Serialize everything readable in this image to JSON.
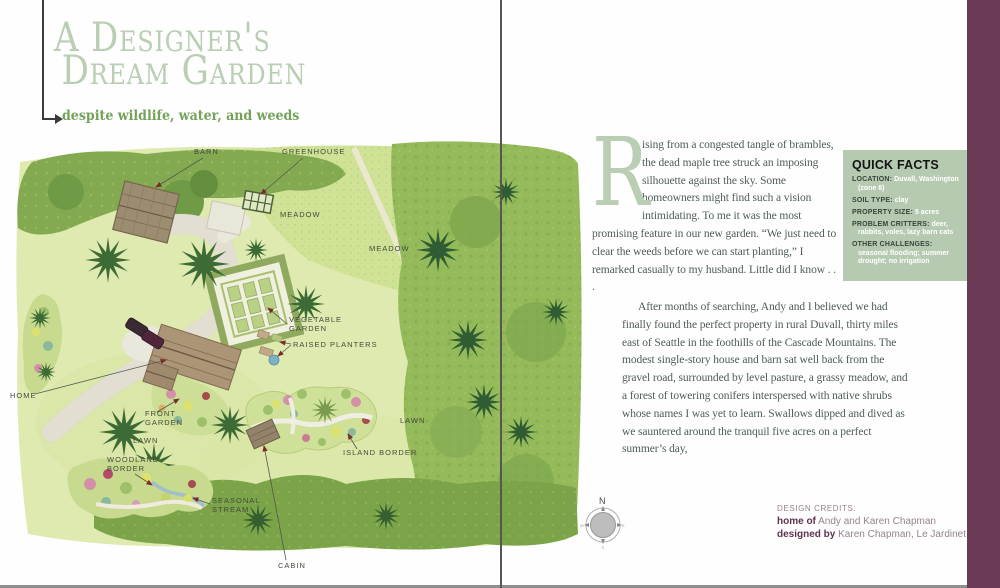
{
  "left_page": {
    "title_line1": "A Designer's",
    "title_line2": "Dream Garden",
    "subtitle": "despite wildlife, water, and weeds",
    "map_labels": {
      "barn": "BARN",
      "greenhouse": "GREENHOUSE",
      "meadow": "MEADOW",
      "vegetable_line1": "VEGETABLE",
      "vegetable_line2": "GARDEN",
      "raised_planters": "RAISED PLANTERS",
      "home": "HOME",
      "front_line1": "FRONT",
      "front_line2": "GARDEN",
      "lawn": "LAWN",
      "woodland_line1": "WOODLAND",
      "woodland_line2": "BORDER",
      "seasonal_line1": "SEASONAL",
      "seasonal_line2": "STREAM",
      "island_border": "ISLAND BORDER",
      "cabin": "CABIN"
    }
  },
  "right_page": {
    "dropcap": "R",
    "para1": "ising from a congested tangle of brambles, the dead maple tree struck an imposing silhouette against the sky. Some homeowners might find such a vision intimidating. To me it was the most promising feature in our new garden. “We just need to clear the weeds before we can start planting,” I remarked casually to my husband. Little did I know . . .",
    "para2": "After months of searching, Andy and I believed we had finally found the perfect property in rural Duvall, thirty miles east of Seattle in the foothills of the Cascade Mountains. The modest single-story house and barn sat well back from the gravel road, surrounded by level pasture, a grassy meadow, and a forest of towering conifers interspersed with native shrubs whose names I was yet to learn. Swallows dipped and dived as we sauntered around the tranquil five acres on a perfect summer’s day,",
    "quick_facts": {
      "title": "QUICK FACTS",
      "items": [
        {
          "label": "LOCATION:",
          "value": "Duvall, Washington (zone 6)"
        },
        {
          "label": "SOIL TYPE:",
          "value": "clay"
        },
        {
          "label": "PROPERTY SIZE:",
          "value": "5 acres"
        },
        {
          "label": "PROBLEM CRITTERS:",
          "value": "deer, rabbits, voles, lazy barn cats"
        },
        {
          "label": "OTHER CHALLENGES:",
          "value": "seasonal flooding; summer drought; no irrigation"
        }
      ]
    },
    "compass": {
      "north": "N",
      "east": "E",
      "south": "S",
      "west": "W"
    },
    "credits": {
      "heading": "DESIGN CREDITS:",
      "home_of_label": "home of",
      "home_of_value": "Andy and Karen Chapman",
      "designed_by_label": "designed by",
      "designed_by_value": "Karen Chapman, Le Jardinet"
    }
  },
  "colors": {
    "title_green": "#b9ceb3",
    "subtitle_green": "#73a259",
    "body_text": "#4e5d55",
    "quick_facts_bg": "#b5cab0",
    "accent_purple": "#6b3a54",
    "credit_gray": "#95838d",
    "credit_plum": "#5e3150",
    "label_arrow_red": "#7a2b2b"
  }
}
